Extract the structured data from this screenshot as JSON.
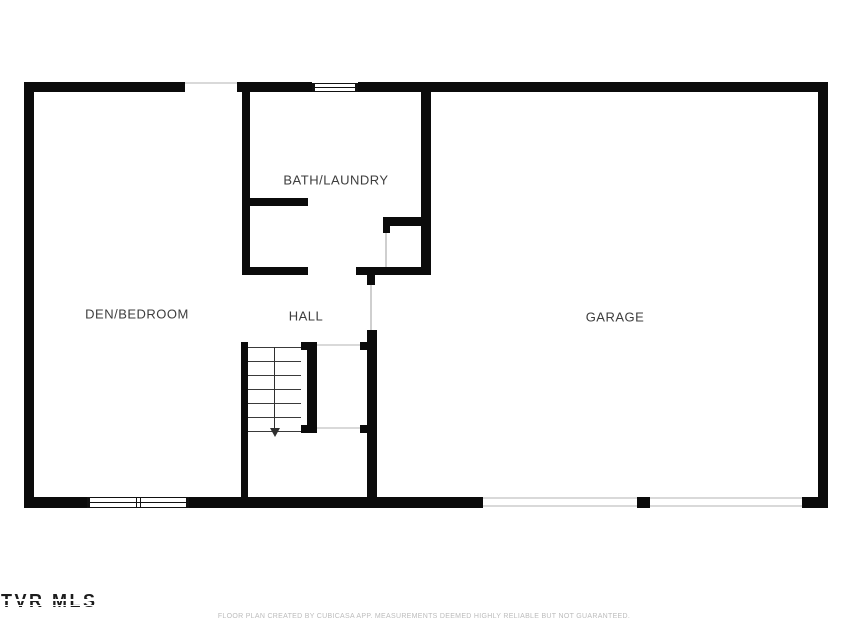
{
  "plan": {
    "type": "floor-plan",
    "level": "lower level with garage"
  },
  "rooms": {
    "bath_laundry": "BATH/LAUNDRY",
    "den_bedroom": "DEN/BEDROOM",
    "hall": "HALL",
    "garage": "GARAGE"
  },
  "stairs": {
    "direction": "down",
    "tread_count": 7
  },
  "footer": {
    "watermark": "TVR MLS",
    "disclaimer": "FLOOR PLAN CREATED BY CUBICASA APP. MEASUREMENTS DEEMED HIGHLY RELIABLE BUT NOT GUARANTEED."
  },
  "colors": {
    "wall": "#0b0b0b",
    "background": "#ffffff",
    "room_label": "#3d3d3d",
    "door_line": "#cfcfcf",
    "disclaimer": "#bcbcbc",
    "watermark": "#1c1c1c"
  }
}
